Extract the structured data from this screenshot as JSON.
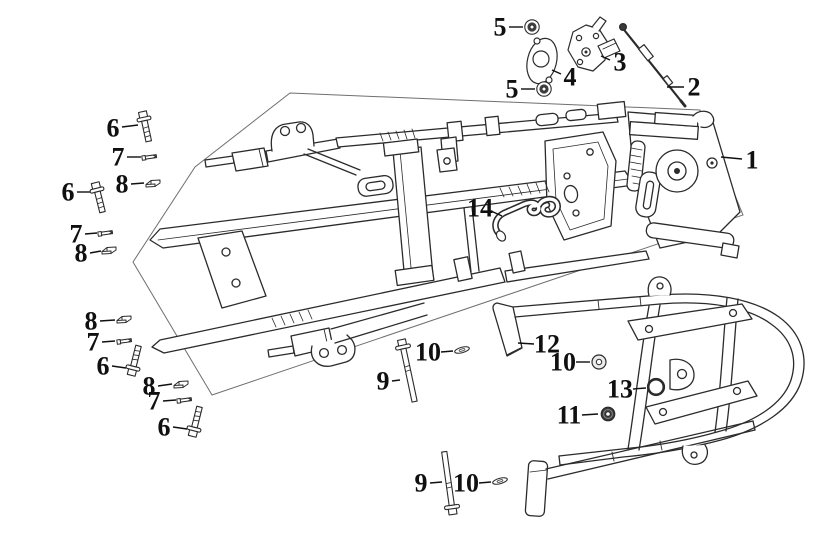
{
  "diagram": {
    "background": "#ffffff",
    "line_color": "#2b2b2b",
    "boundary_color": "#6f6f6f",
    "label_color": "#101010",
    "label_font_px": 26,
    "leader_width": 1.4
  },
  "callouts": [
    {
      "label": "1",
      "part": "frame-assembly",
      "icon": "none",
      "lx": 752,
      "ly": 160,
      "leader": [
        742,
        159,
        721,
        157
      ]
    },
    {
      "label": "2",
      "part": "lock-cable",
      "icon": "none",
      "lx": 694,
      "ly": 87,
      "leader": [
        684,
        87,
        667,
        87
      ]
    },
    {
      "label": "3",
      "part": "seat-lock",
      "icon": "none",
      "lx": 620,
      "ly": 62,
      "leader": [
        610,
        60,
        601,
        56
      ]
    },
    {
      "label": "4",
      "part": "lock-bracket-plate",
      "icon": "none",
      "lx": 570,
      "ly": 77,
      "leader": [
        561,
        74,
        552,
        70
      ]
    },
    {
      "label": "5",
      "part": "washer",
      "icon": "washer",
      "lx": 500,
      "ly": 27,
      "leader": [
        509,
        27,
        523,
        27
      ],
      "ix": 532,
      "iy": 27,
      "rot": 0
    },
    {
      "label": "5",
      "part": "washer",
      "icon": "washer",
      "lx": 512,
      "ly": 89,
      "leader": [
        521,
        89,
        535,
        89
      ],
      "ix": 544,
      "iy": 89,
      "rot": 0
    },
    {
      "label": "6",
      "part": "flange-bolt",
      "icon": "bolt",
      "lx": 113,
      "ly": 128,
      "leader": [
        122,
        127,
        138,
        125
      ],
      "ix": 144,
      "iy": 119,
      "rot": -12
    },
    {
      "label": "6",
      "part": "flange-bolt",
      "icon": "bolt",
      "lx": 68,
      "ly": 192,
      "leader": [
        77,
        192,
        91,
        192
      ],
      "ix": 97,
      "iy": 190,
      "rot": -14
    },
    {
      "label": "6",
      "part": "flange-bolt",
      "icon": "bolt",
      "lx": 103,
      "ly": 366,
      "leader": [
        112,
        366,
        126,
        368
      ],
      "ix": 133,
      "iy": 368,
      "rot": 194
    },
    {
      "label": "6",
      "part": "flange-bolt",
      "icon": "bolt",
      "lx": 164,
      "ly": 427,
      "leader": [
        173,
        427,
        187,
        429
      ],
      "ix": 194,
      "iy": 429,
      "rot": 194
    },
    {
      "label": "7",
      "part": "pin-screw",
      "icon": "pin",
      "lx": 118,
      "ly": 157,
      "leader": [
        127,
        157,
        141,
        157
      ],
      "ix": 150,
      "iy": 157,
      "rot": -8
    },
    {
      "label": "7",
      "part": "pin-screw",
      "icon": "pin",
      "lx": 76,
      "ly": 234,
      "leader": [
        85,
        234,
        97,
        233
      ],
      "ix": 106,
      "iy": 233,
      "rot": -8
    },
    {
      "label": "7",
      "part": "pin-screw",
      "icon": "pin",
      "lx": 93,
      "ly": 342,
      "leader": [
        102,
        342,
        115,
        341
      ],
      "ix": 125,
      "iy": 341,
      "rot": -8
    },
    {
      "label": "7",
      "part": "pin-screw",
      "icon": "pin",
      "lx": 154,
      "ly": 401,
      "leader": [
        163,
        401,
        176,
        400
      ],
      "ix": 185,
      "iy": 400,
      "rot": -8
    },
    {
      "label": "8",
      "part": "clip-nut",
      "icon": "clip",
      "lx": 122,
      "ly": 184,
      "leader": [
        131,
        184,
        144,
        183
      ],
      "ix": 153,
      "iy": 183,
      "rot": 0
    },
    {
      "label": "8",
      "part": "clip-nut",
      "icon": "clip",
      "lx": 81,
      "ly": 253,
      "leader": [
        90,
        253,
        101,
        251
      ],
      "ix": 109,
      "iy": 250,
      "rot": 0
    },
    {
      "label": "8",
      "part": "clip-nut",
      "icon": "clip",
      "lx": 91,
      "ly": 321,
      "leader": [
        100,
        321,
        115,
        320
      ],
      "ix": 124,
      "iy": 319,
      "rot": 0
    },
    {
      "label": "8",
      "part": "clip-nut",
      "icon": "clip",
      "lx": 149,
      "ly": 386,
      "leader": [
        158,
        386,
        172,
        384
      ],
      "ix": 181,
      "iy": 384,
      "rot": 0
    },
    {
      "label": "9",
      "part": "long-bolt",
      "icon": "bolt-long",
      "lx": 383,
      "ly": 381,
      "leader": [
        392,
        381,
        400,
        380
      ],
      "ix": 403,
      "iy": 347,
      "rot": -12
    },
    {
      "label": "9",
      "part": "long-bolt",
      "icon": "bolt-long",
      "lx": 421,
      "ly": 483,
      "leader": [
        430,
        483,
        442,
        482
      ],
      "ix": 452,
      "iy": 507,
      "rot": 172
    },
    {
      "label": "10",
      "part": "washer",
      "icon": "washer-edge",
      "lx": 428,
      "ly": 352,
      "leader": [
        441,
        352,
        453,
        351
      ],
      "ix": 462,
      "iy": 350,
      "rot": -15
    },
    {
      "label": "10",
      "part": "washer",
      "icon": "washer-edge",
      "lx": 466,
      "ly": 483,
      "leader": [
        479,
        483,
        491,
        482
      ],
      "ix": 500,
      "iy": 481,
      "rot": -15
    },
    {
      "label": "10",
      "part": "washer",
      "icon": "washer-flat",
      "lx": 563,
      "ly": 362,
      "leader": [
        576,
        362,
        590,
        362
      ],
      "ix": 599,
      "iy": 362,
      "rot": 0
    },
    {
      "label": "11",
      "part": "nut",
      "icon": "nut",
      "lx": 569,
      "ly": 415,
      "leader": [
        582,
        415,
        598,
        414
      ],
      "ix": 608,
      "iy": 414,
      "rot": 0
    },
    {
      "label": "12",
      "part": "carrier-tube",
      "icon": "none",
      "lx": 547,
      "ly": 344,
      "leader": [
        534,
        344,
        518,
        343
      ]
    },
    {
      "label": "13",
      "part": "ring",
      "icon": "ring",
      "lx": 620,
      "ly": 389,
      "leader": [
        633,
        389,
        646,
        388
      ],
      "ix": 656,
      "iy": 387,
      "rot": 0
    },
    {
      "label": "14",
      "part": "r-pin-clip",
      "icon": "none",
      "lx": 480,
      "ly": 208,
      "leader": [
        491,
        211,
        502,
        216
      ]
    }
  ]
}
